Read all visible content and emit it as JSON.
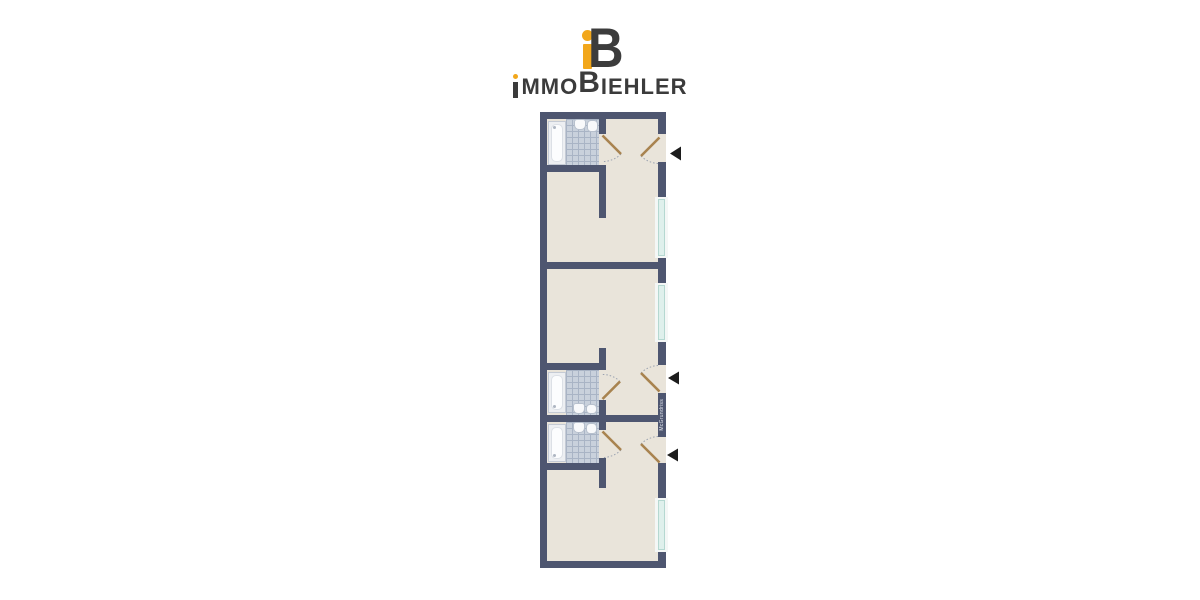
{
  "brand": {
    "name": "ImmoBiehler",
    "monogram": {
      "letter_b": "B",
      "icon": "immobiehler-ib-monogram-icon"
    },
    "wordmark": {
      "segment_mmo": "MMO",
      "segment_b": "B",
      "segment_iehler": "IEHLER"
    },
    "colors": {
      "accent_orange": "#F2A71B",
      "ink": "#3B3B3B"
    }
  },
  "floorplan": {
    "kind": "apartment-floor-plan-three-units",
    "watermark_vertical_text": "McGrundriss",
    "colors": {
      "wall": "#4E5670",
      "floor": "#E9E4DA",
      "bathroom_tile": "#C9D1DC",
      "window_glass": "#DFF0EC",
      "door_leaf": "#A8834F",
      "entry_arrow": "#1C1C1C"
    },
    "units": [
      {
        "name": "unit-top",
        "features": [
          "bathroom-bathtub",
          "bathroom-sink",
          "bathroom-toilet",
          "entry-door-right",
          "window-right"
        ]
      },
      {
        "name": "unit-middle",
        "features": [
          "bathroom-bathtub",
          "bathroom-sink",
          "bathroom-toilet",
          "entry-door-right",
          "window-right"
        ]
      },
      {
        "name": "unit-bottom",
        "features": [
          "bathroom-bathtub",
          "bathroom-sink",
          "bathroom-toilet",
          "entry-door-right",
          "window-right"
        ]
      }
    ]
  }
}
